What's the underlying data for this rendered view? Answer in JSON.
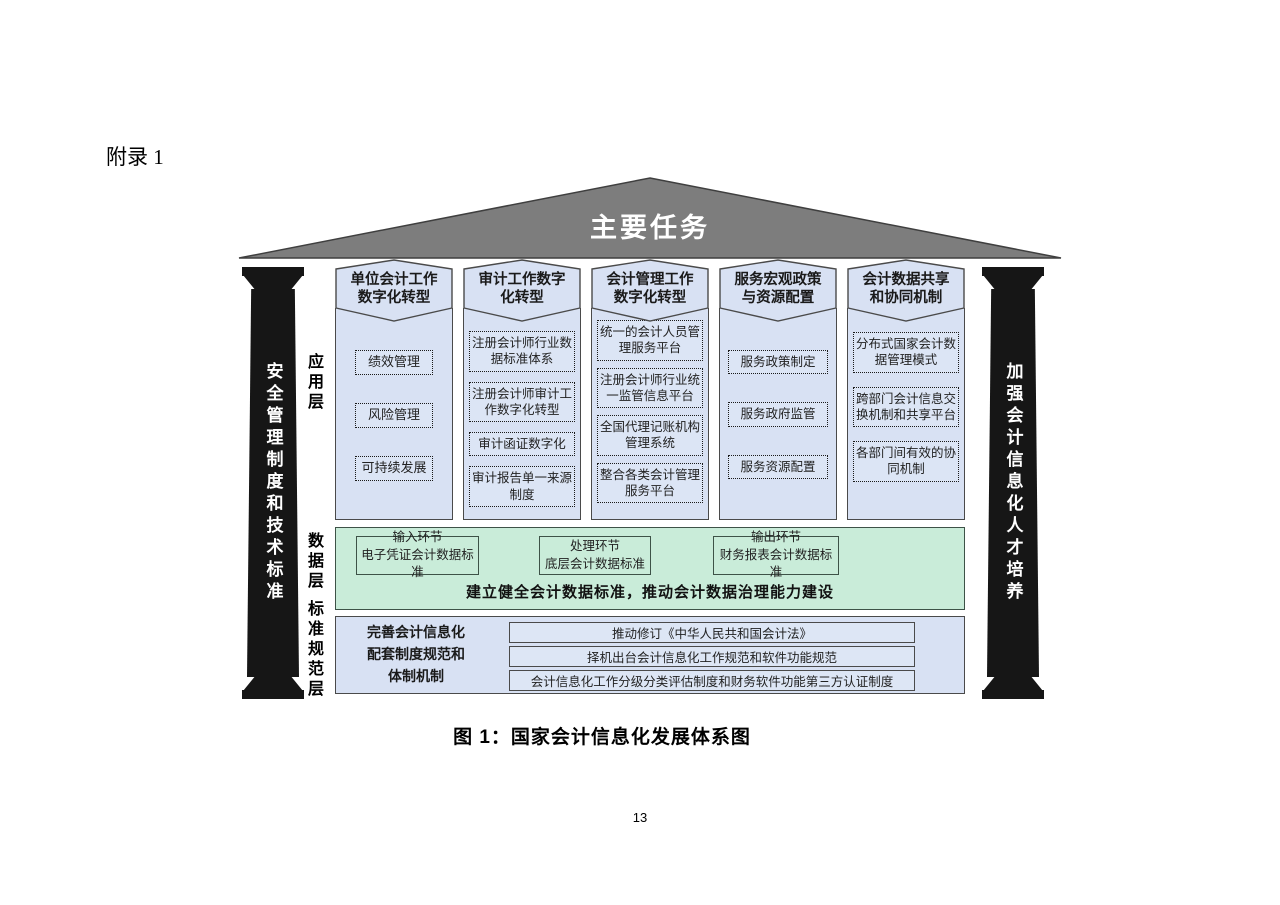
{
  "page": {
    "appendix_label": "附录 1",
    "caption": "图 1：国家会计信息化发展体系图",
    "page_number": "13"
  },
  "diagram": {
    "roof_title": "主要任务",
    "left_pillar": "安全管理制度和技术标准",
    "right_pillar": "加强会计信息化人才培养",
    "layer_labels": {
      "application": "应用层",
      "data": "数据层",
      "standards": "标准规范层"
    },
    "columns": [
      {
        "header": "单位会计工作数字化转型",
        "items": [
          "绩效管理",
          "风险管理",
          "可持续发展"
        ]
      },
      {
        "header": "审计工作数字化转型",
        "items": [
          "注册会计师行业数据标准体系",
          "注册会计师审计工作数字化转型",
          "审计函证数字化",
          "审计报告单一来源制度"
        ]
      },
      {
        "header": "会计管理工作数字化转型",
        "items": [
          "统一的会计人员管理服务平台",
          "注册会计师行业统一监管信息平台",
          "全国代理记账机构管理系统",
          "整合各类会计管理服务平台"
        ]
      },
      {
        "header": "服务宏观政策与资源配置",
        "items": [
          "服务政策制定",
          "服务政府监管",
          "服务资源配置"
        ]
      },
      {
        "header": "会计数据共享和协同机制",
        "items": [
          "分布式国家会计数据管理模式",
          "跨部门会计信息交换机制和共享平台",
          "各部门间有效的协同机制"
        ]
      }
    ],
    "data_layer": {
      "boxes": [
        {
          "line1": "输入环节",
          "line2": "电子凭证会计数据标准"
        },
        {
          "line1": "处理环节",
          "line2": "底层会计数据标准"
        },
        {
          "line1": "输出环节",
          "line2": "财务报表会计数据标准"
        }
      ],
      "summary": "建立健全会计数据标准，推动会计数据治理能力建设"
    },
    "standards_layer": {
      "label_lines": [
        "完善会计信息化",
        "配套制度规范和",
        "体制机制"
      ],
      "rows": [
        "推动修订《中华人民共和国会计法》",
        "择机出台会计信息化工作规范和软件功能规范",
        "会计信息化工作分级分类评估制度和财务软件功能第三方认证制度"
      ]
    },
    "colors": {
      "roof_fill": "#7d7d7d",
      "pillar_fill": "#161616",
      "column_fill": "#d8e1f3",
      "data_fill": "#c9ecd9",
      "border": "#4a4a4a"
    }
  }
}
